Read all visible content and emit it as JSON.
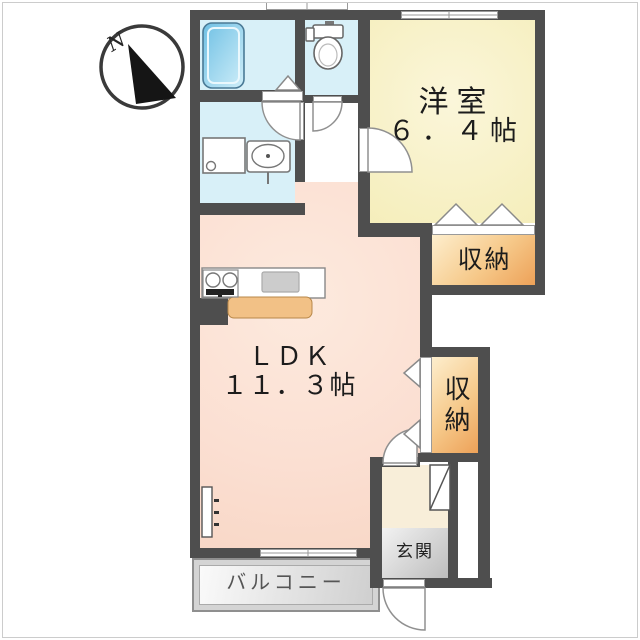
{
  "compass": {
    "north_label": "N"
  },
  "rooms": {
    "western": {
      "name": "洋室",
      "area": "６．４帖"
    },
    "ldk": {
      "name": "ＬＤＫ",
      "area": "１１．３帖"
    },
    "closet_upper": {
      "name": "収納"
    },
    "closet_side": {
      "name": "収納"
    },
    "entrance": {
      "name": "玄関"
    },
    "balcony": {
      "name": "バルコニー"
    }
  },
  "icons": [
    "compass-icon",
    "bathtub-icon",
    "toilet-icon",
    "washing-machine-icon",
    "washbasin-icon",
    "stove-icon",
    "kitchen-sink-icon",
    "kitchen-counter",
    "shoe-cabinet-icon",
    "wall-fixture-icon",
    "door-arc",
    "bifold-door-icon",
    "window-icon"
  ],
  "colors": {
    "wall": "#4e4e4e",
    "ldk_fill": "#fbdfd2",
    "western_room_fill": "#f5eebb",
    "wet_area_fill": "#d8f0f8",
    "closet_fill_light": "#fdeecd",
    "closet_fill_dark": "#eda158",
    "entrance_hall_fill": "#f8eed9",
    "genkan_fill": "#d9d9d9",
    "balcony_fill": "#e0e0e0",
    "bathtub_fill": "#7cc5e6",
    "kitchen_counter_fill": "#f2c186"
  }
}
